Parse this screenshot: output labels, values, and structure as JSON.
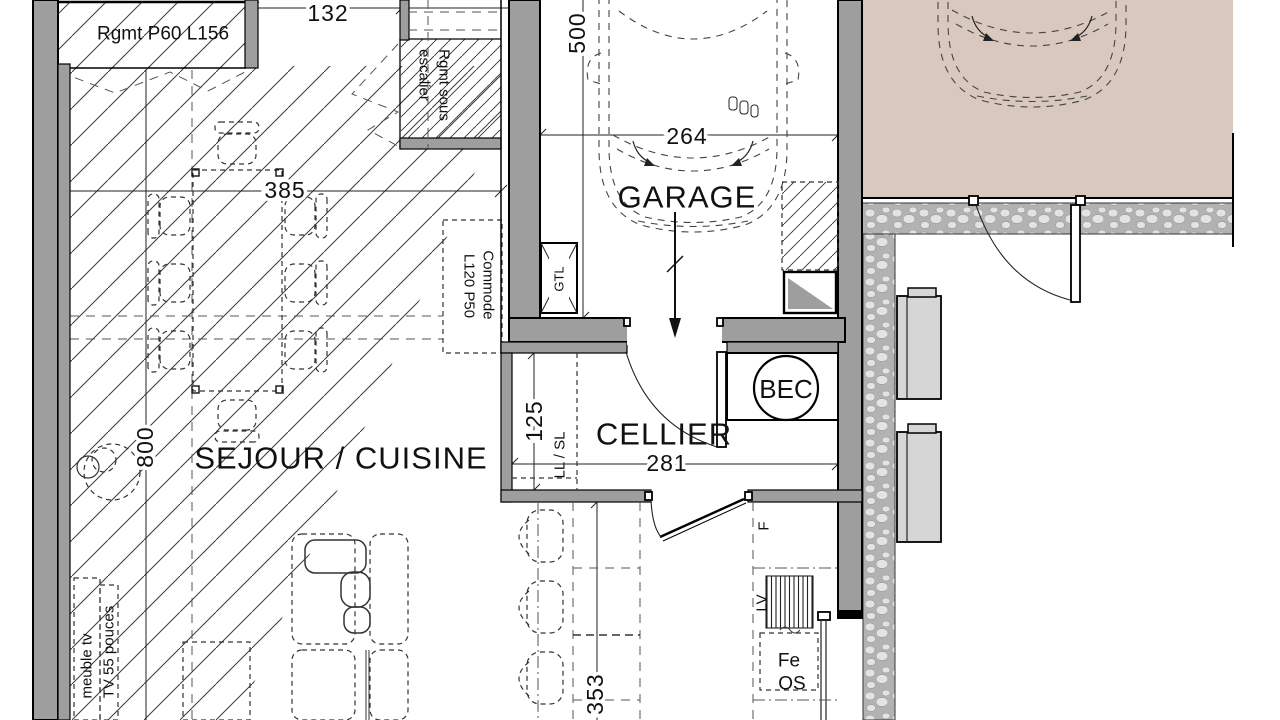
{
  "title": "Plan de rez-de-chaussee - maison",
  "rooms": {
    "sejour": "SEJOUR / CUISINE",
    "garage": "GARAGE",
    "cellier": "CELLIER"
  },
  "dims": {
    "d132": "132",
    "d385": "385",
    "d500": "500",
    "d264": "264",
    "d800": "800",
    "d125": "125",
    "d281": "281",
    "d353": "353"
  },
  "labels": {
    "rgmt_p60": "Rgmt P60 L156",
    "rgmt_sous_1": "Rgmt sous",
    "rgmt_sous_2": "escalier",
    "commode_1": "Commode",
    "commode_2": "L120 P50",
    "gtl": "GTL",
    "bec": "BEC",
    "ll_sl": "LL / SL",
    "fridge": "F",
    "lv": "LV",
    "fe": "Fe",
    "os": "OS",
    "meuble_tv": "meuble tv",
    "tv": "TV 55 pouces"
  },
  "colors": {
    "wall": "#9e9e9e",
    "driveway": "#d9c8bd",
    "appliance": "#d6d6d6",
    "line": "#1a1a1a",
    "paper": "#ffffff"
  }
}
